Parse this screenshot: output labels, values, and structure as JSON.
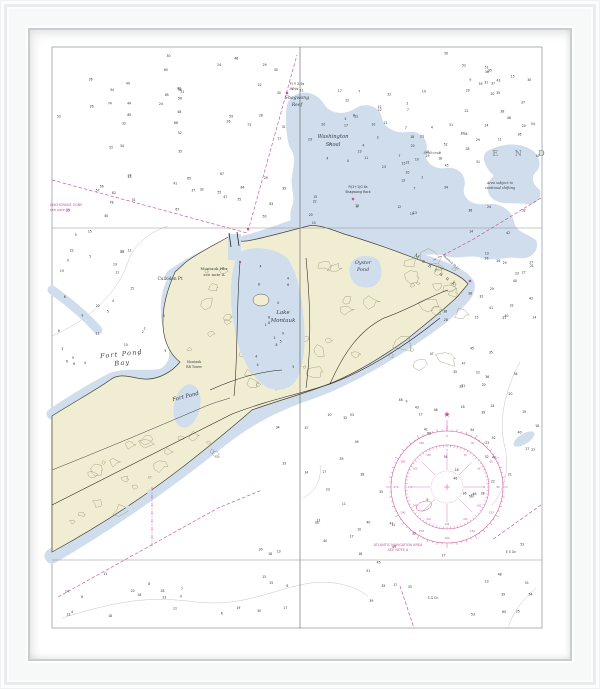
{
  "labels": {
    "fort_pond_bay": "Fort Pond\nBay",
    "fort_pond": "Fort Pond",
    "lake_montauk": "Lake\nMontauk",
    "oyster_pond": "Oyster\nPond",
    "washington_shoal": "Washington\nShoal",
    "shagwong_reef": "Shagwong\nReef",
    "buoy_yellow": "Fl Y 2.5s\nWhis",
    "shagwong_rock": "Fl(2+1)G 6s\nShagwong Rock",
    "end_letters": "E  N  D",
    "seahorse": "Seahorse",
    "shifting_note": "Area subject to\ncontinual shifting",
    "culloden_pt": "Culloden Pt",
    "montauk_hbr": "Montauk Hbr\nsee note A",
    "montauk_rr": "Montauk\nRR Tower",
    "montauk_diag": "Montauk",
    "montauk_pt_light": "Montauk Pt Lt",
    "anchorage_note": "ANCHORAGE ZONE\nsee note 25",
    "nav_area_note": "ATLANTIC NAVIGATION AREA\nSEE NOTE A",
    "buoy_es": "E S Gn",
    "buoy_sg": "S G Cn"
  },
  "icons": {
    "star": "★"
  },
  "colors": {
    "frame": "#fbfbfc",
    "mat": "#ffffff",
    "paper": "#ffffff",
    "land": "#f1edd3",
    "water": "#cfdded",
    "magenta": "#c8509b",
    "land_contour": "#84815f",
    "sounding": "#2e2e2e"
  },
  "compass": {
    "cx": 447,
    "cy": 487,
    "r_outer": 56,
    "r_mid": 42,
    "r_inner": 16,
    "tick_step": 5,
    "label_step": 30,
    "font_outer": 2.6,
    "font_mid": 2.3
  },
  "soundings": {
    "seed": 20,
    "zones": [
      [
        58,
        52,
        230,
        170,
        58,
        20,
        85
      ],
      [
        296,
        88,
        138,
        142,
        50,
        2,
        24
      ],
      [
        438,
        52,
        100,
        142,
        36,
        8,
        55
      ],
      [
        470,
        205,
        70,
        115,
        22,
        12,
        42
      ],
      [
        480,
        325,
        58,
        295,
        26,
        18,
        60
      ],
      [
        305,
        400,
        170,
        218,
        48,
        8,
        55
      ],
      [
        255,
        425,
        45,
        190,
        10,
        6,
        40
      ],
      [
        62,
        572,
        190,
        48,
        16,
        4,
        30
      ],
      [
        60,
        232,
        90,
        75,
        14,
        3,
        22
      ],
      [
        56,
        310,
        55,
        58,
        8,
        3,
        12
      ],
      [
        250,
        262,
        50,
        112,
        15,
        1,
        9
      ],
      [
        100,
        300,
        68,
        58,
        8,
        2,
        10
      ],
      [
        430,
        305,
        80,
        90,
        12,
        18,
        48
      ]
    ]
  },
  "texture": {
    "seed": 9,
    "zones": [
      [
        60,
        445,
        62,
        90,
        8,
        5
      ],
      [
        118,
        425,
        58,
        75,
        8,
        5
      ],
      [
        172,
        402,
        55,
        55,
        6,
        4
      ],
      [
        188,
        300,
        64,
        85,
        9,
        5
      ],
      [
        305,
        252,
        58,
        125,
        9,
        5
      ],
      [
        358,
        256,
        100,
        108,
        15,
        8
      ],
      [
        418,
        268,
        45,
        48,
        6,
        5
      ],
      [
        242,
        352,
        70,
        40,
        6,
        4
      ],
      [
        205,
        255,
        40,
        45,
        5,
        4
      ]
    ]
  }
}
